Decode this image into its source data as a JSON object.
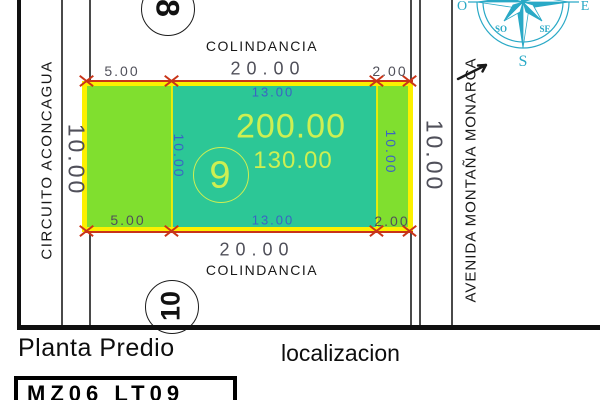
{
  "document": {
    "plan_label": "Planta Predio",
    "location_label": "localizacion",
    "lot_code": "MZ06 LT09"
  },
  "streets": {
    "left_name": "CIRCUITO ACONCAGUA",
    "right_name": "AVENIDA MONTAÑA MONARCA",
    "left_width": "10.00",
    "right_width": "10.00"
  },
  "boundaries": {
    "top": "COLINDANCIA",
    "bottom": "COLINDANCIA"
  },
  "lot": {
    "number": "9",
    "area_total": "200.00",
    "area_inner": "130.00"
  },
  "adjacent_lots": {
    "north": "8",
    "south": "10"
  },
  "dimensions": {
    "width_top": "20.00",
    "width_bottom": "20.00",
    "left_offset_top": "5.00",
    "left_offset_bottom": "5.00",
    "right_offset_top": "2.00",
    "right_offset_bottom": "2.00",
    "inner_width_top": "13.00",
    "inner_width_bottom": "13.00",
    "depth_left": "10.00",
    "depth_right": "10.00"
  },
  "compass": {
    "west": "O",
    "east": "E",
    "southwest": "SO",
    "southeast": "SE",
    "south": "S"
  },
  "colors": {
    "teal": "#2cc796",
    "green": "#80df2f",
    "yellow": "#fcf000",
    "area_text": "#cdef52",
    "dim_blue": "#3b63c4",
    "dim_gray": "#50505a",
    "red": "#c93418",
    "compass": "#2aa9c6",
    "ink": "#191919"
  }
}
